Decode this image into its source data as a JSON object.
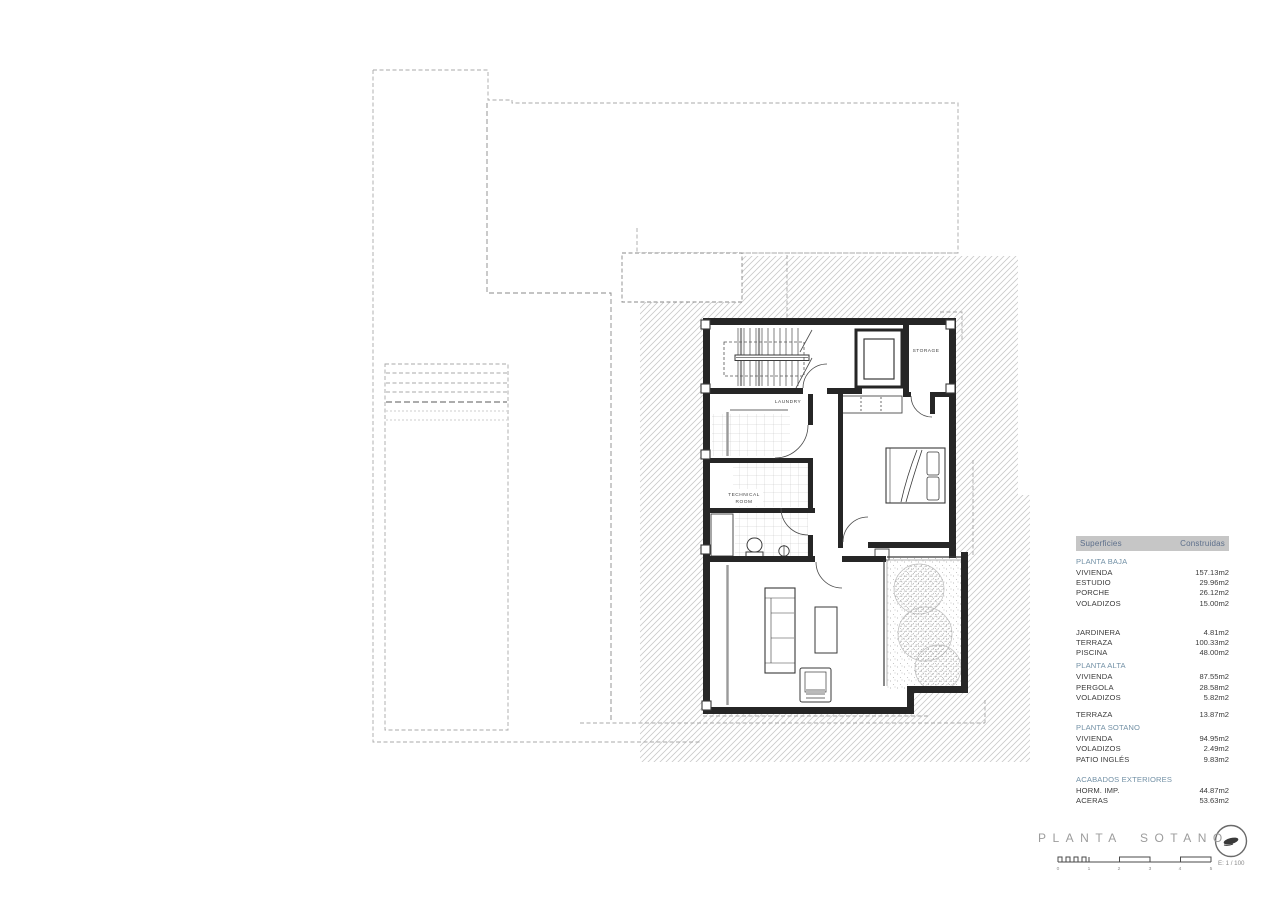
{
  "drawing": {
    "room_labels": {
      "laundry": "LAUNDRY",
      "technical_line1": "TECHNICAL",
      "technical_line2": "ROOM",
      "storage": "STORAGE"
    }
  },
  "surfaces_table": {
    "header": {
      "col1": "Superficies",
      "col2": "Construidas"
    },
    "rows": [
      {
        "type": "section",
        "label": "PLANTA BAJA",
        "value": ""
      },
      {
        "type": "item",
        "label": "VIVIENDA",
        "value": "157.13m2"
      },
      {
        "type": "item",
        "label": "ESTUDIO",
        "value": "29.96m2"
      },
      {
        "type": "item",
        "label": "PORCHE",
        "value": "26.12m2"
      },
      {
        "type": "item",
        "label": "VOLADIZOS",
        "value": "15.00m2"
      },
      {
        "type": "spacer-lg",
        "label": "",
        "value": ""
      },
      {
        "type": "item",
        "label": "JARDINERA",
        "value": "4.81m2"
      },
      {
        "type": "item",
        "label": "TERRAZA",
        "value": "100.33m2"
      },
      {
        "type": "item",
        "label": "PISCINA",
        "value": "48.00m2"
      },
      {
        "type": "section",
        "label": "PLANTA ALTA",
        "value": ""
      },
      {
        "type": "item",
        "label": "VIVIENDA",
        "value": "87.55m2"
      },
      {
        "type": "item",
        "label": "PERGOLA",
        "value": "28.58m2"
      },
      {
        "type": "item",
        "label": "VOLADIZOS",
        "value": "5.82m2"
      },
      {
        "type": "spacer-sm",
        "label": "",
        "value": ""
      },
      {
        "type": "item",
        "label": "TERRAZA",
        "value": "13.87m2"
      },
      {
        "type": "section",
        "label": "PLANTA SOTANO",
        "value": ""
      },
      {
        "type": "item",
        "label": "VIVIENDA",
        "value": "94.95m2"
      },
      {
        "type": "item",
        "label": "VOLADIZOS",
        "value": "2.49m2"
      },
      {
        "type": "item",
        "label": "PATIO INGLÉS",
        "value": "9.83m2"
      },
      {
        "type": "spacer-sm",
        "label": "",
        "value": ""
      },
      {
        "type": "section",
        "label": "ACABADOS EXTERIORES",
        "value": ""
      },
      {
        "type": "item",
        "label": "HORM. IMP.",
        "value": "44.87m2"
      },
      {
        "type": "item",
        "label": "ACERAS",
        "value": "53.63m2"
      }
    ]
  },
  "title_block": {
    "title": "PLANTA SOTANO",
    "scale_label": "E: 1 / 100",
    "scale_ticks": [
      "0",
      "1",
      "2",
      "3",
      "4",
      "5"
    ]
  },
  "colors": {
    "table_header_bg": "#c6c6c6",
    "table_header_text": "#5d6f8b",
    "table_section_text": "#7391a6",
    "title_text": "#9c9c9c",
    "wall": "#262626",
    "hatch_line": "#c9c9c9"
  }
}
